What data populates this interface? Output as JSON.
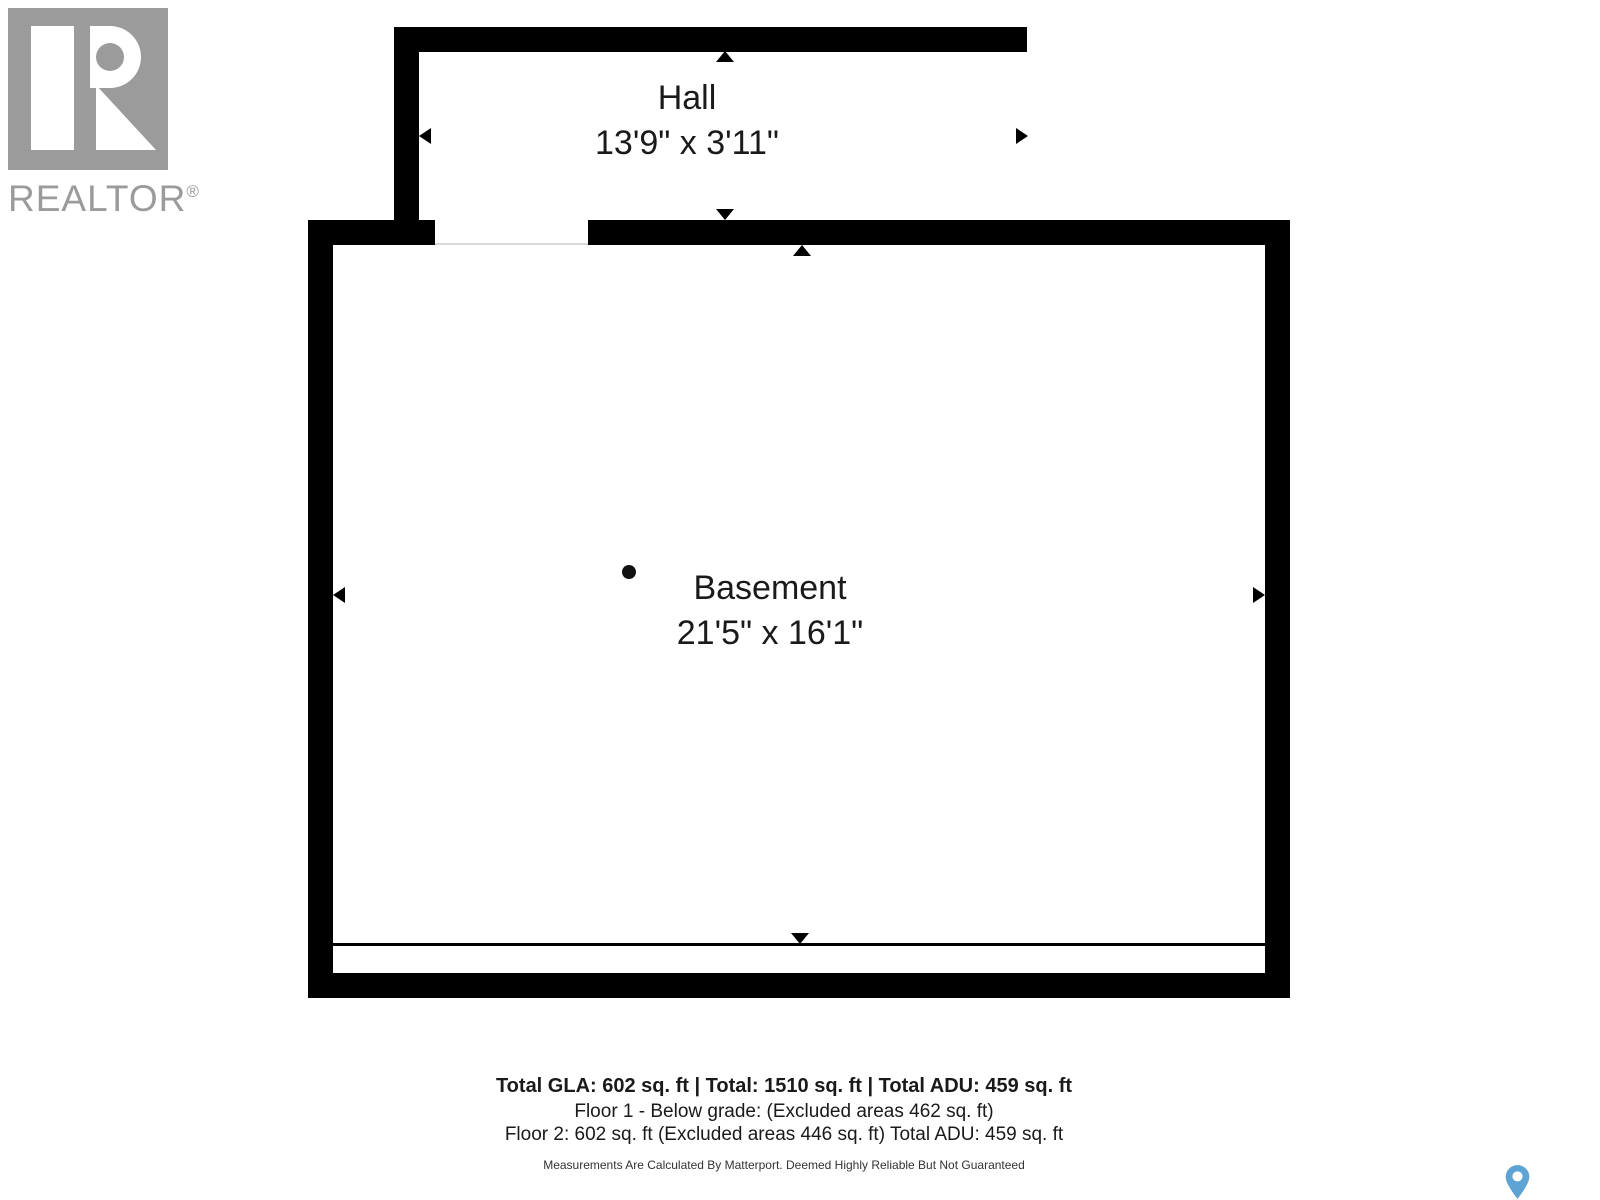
{
  "branding": {
    "realtor_logo_text": "REALTOR",
    "registered_mark": "®",
    "logo_color": "#9b9b9b"
  },
  "floorplan": {
    "rooms": [
      {
        "name": "Hall",
        "dimensions": "13'9\" x 3'11\""
      },
      {
        "name": "Basement",
        "dimensions": "21'5\" x 16'1\""
      }
    ],
    "wall_color": "#000000",
    "text_color": "#1a1a1a"
  },
  "footer": {
    "totals_line": "Total GLA: 602 sq. ft | Total: 1510 sq. ft | Total ADU: 459 sq. ft",
    "floor1_line": "Floor 1 - Below grade: (Excluded areas 462 sq. ft)",
    "floor2_line": "Floor 2: 602 sq. ft (Excluded areas 446 sq. ft) Total ADU: 459 sq. ft",
    "disclaimer": "Measurements Are Calculated By Matterport. Deemed Highly Reliable But Not Guaranteed"
  },
  "icons": {
    "map_pin": "location-pin",
    "map_pin_color": "#5da3d3"
  }
}
